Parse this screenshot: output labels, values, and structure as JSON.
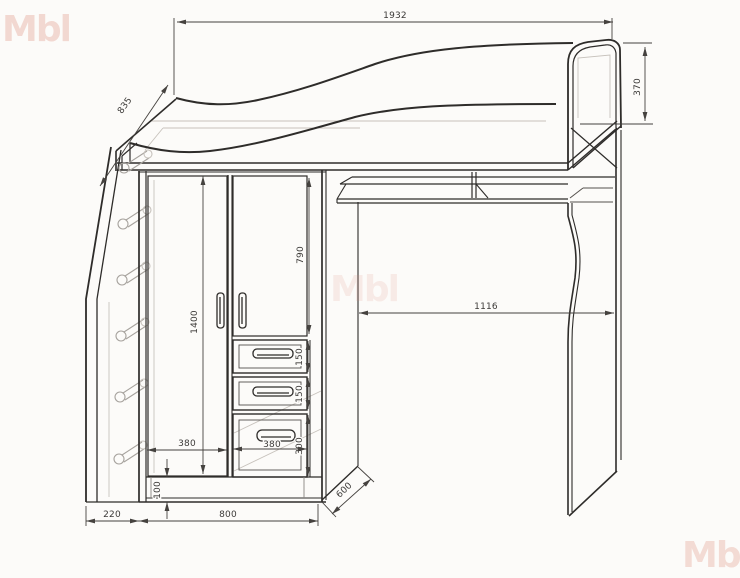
{
  "watermark": {
    "text": "Mbl"
  },
  "dimensions": {
    "bed_length": "1932",
    "headboard_height": "370",
    "bed_depth": "835",
    "wardrobe_interior_height": "1400",
    "door_height": "790",
    "drawer_height_1": "150",
    "drawer_height_2": "150",
    "drawer_height_3": "300",
    "door_width": "380",
    "drawer_width": "380",
    "plinth_height": "100",
    "ladder_offset": "220",
    "wardrobe_width": "800",
    "unit_depth": "600",
    "desk_opening_width": "1116"
  }
}
